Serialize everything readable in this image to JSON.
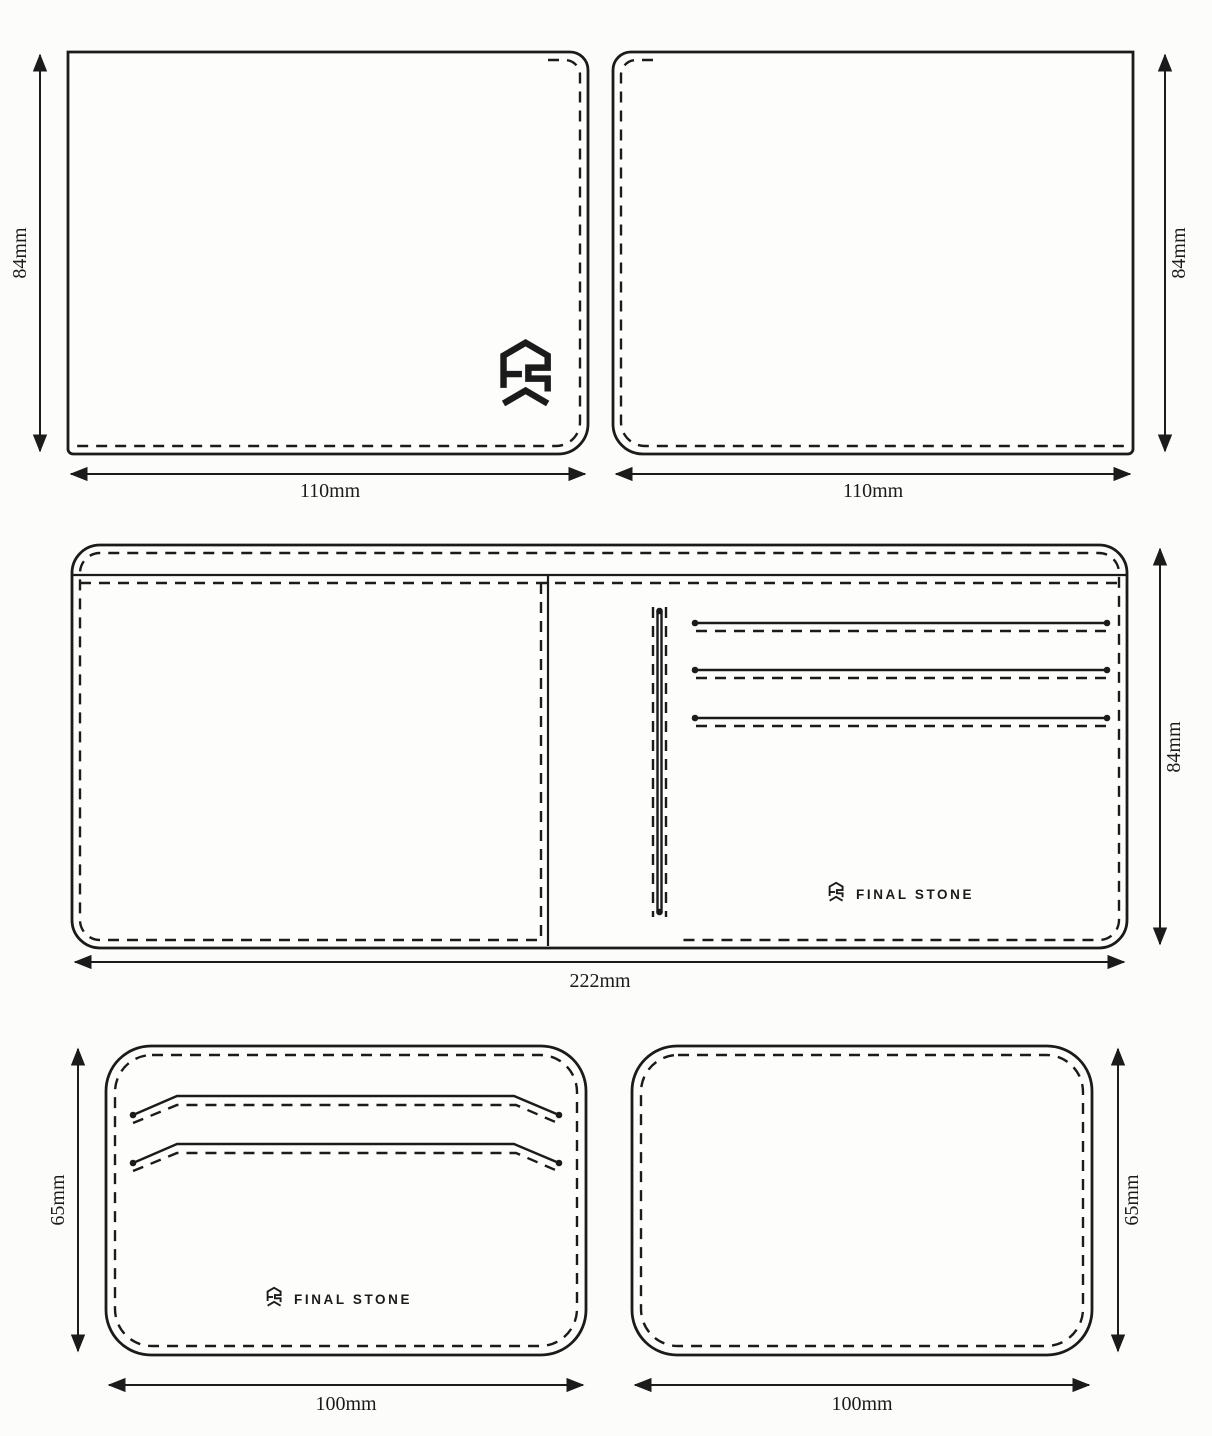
{
  "brand": "FINAL STONE",
  "colors": {
    "line": "#1b1b1b",
    "paper": "#fdfdfb"
  },
  "pieces": {
    "outer_left": {
      "width": "110mm",
      "height": "84mm"
    },
    "outer_right": {
      "width": "110mm",
      "height": "84mm"
    },
    "interior": {
      "width": "222mm",
      "height": "84mm"
    },
    "pocket_front": {
      "width": "100mm",
      "height": "65mm"
    },
    "pocket_back": {
      "width": "100mm",
      "height": "65mm"
    }
  }
}
